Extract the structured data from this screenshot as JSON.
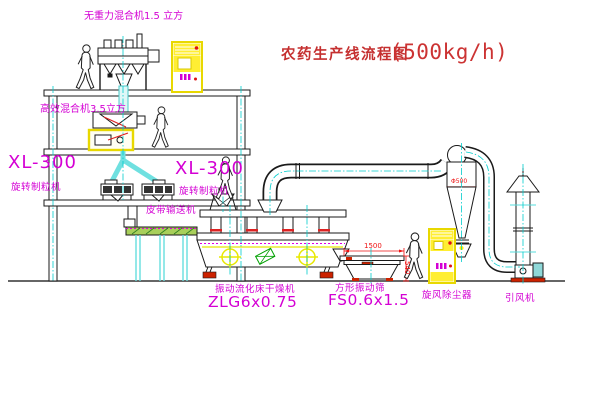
{
  "title": {
    "main": "农药生产线流程图",
    "capacity": "(500kg/h)"
  },
  "labels": {
    "mixer_top": "无重力混合机1.5 立方",
    "mixer_mid": "高效混合机3.5立方",
    "granulator_left_model": "XL-300",
    "granulator_left_name": "旋转制粒机",
    "granulator_mid_model": "XL-300",
    "granulator_mid_name": "旋转制粒机",
    "belt_conveyor": "皮带输送机",
    "dryer_name": "振动流化床干燥机",
    "dryer_model": "ZLG6x0.75",
    "sieve_name": "方形振动筛",
    "sieve_model": "FS0.6x1.5",
    "cyclone_name": "旋风除尘器",
    "fan_name": "引风机"
  },
  "dimensions": {
    "sieve_width": "1500",
    "sieve_height": "540",
    "cyclone_diameter": "Φ500"
  },
  "colors": {
    "label_magenta": "#d400d4",
    "title_red": "#c53030",
    "dimension_red": "#ee1111",
    "cabinet_yellow": "#f0e600",
    "centerline_cyan": "#00cdcd",
    "belt_green": "#7cbf3f"
  }
}
